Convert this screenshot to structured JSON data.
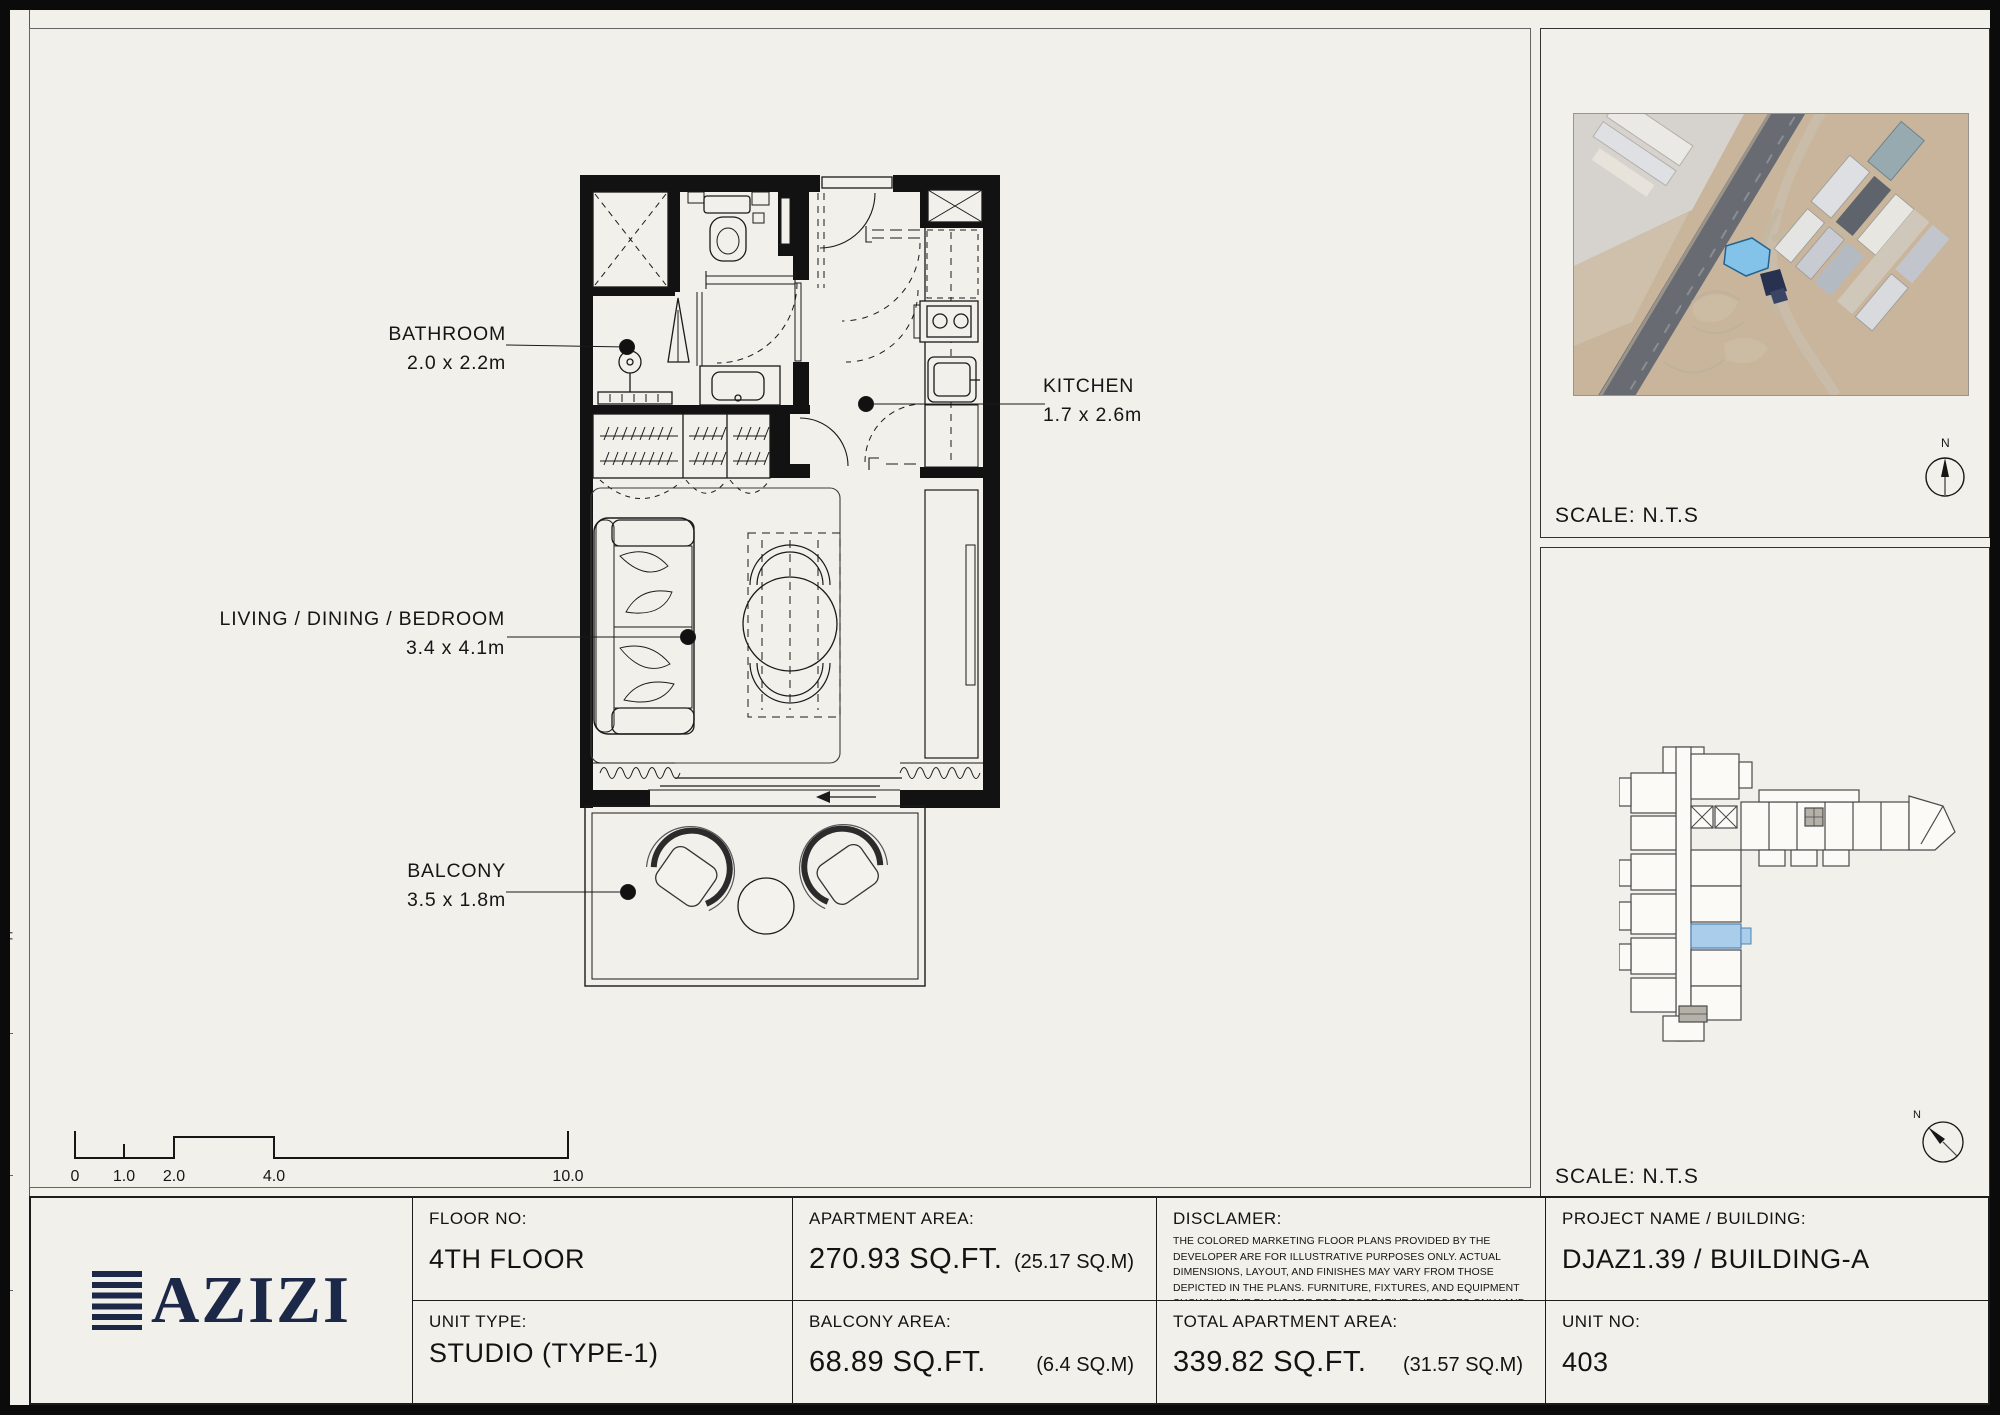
{
  "side_strip": {
    "s0": "SHEET SIZE A3",
    "s1": "DRAWN :    Author",
    "s2": "REVIEWED :    Checker",
    "s3": "APPROVED :    Approver"
  },
  "plan": {
    "bathroom": {
      "name": "BATHROOM",
      "dims": "2.0 x 2.2m"
    },
    "kitchen": {
      "name": "KITCHEN",
      "dims": "1.7 x 2.6m"
    },
    "living": {
      "name": "LIVING / DINING / BEDROOM",
      "dims": "3.4 x 4.1m"
    },
    "balcony": {
      "name": "BALCONY",
      "dims": "3.5 x 1.8m"
    }
  },
  "scale_bar": {
    "ticks": [
      "0",
      "1.0",
      "2.0",
      "4.0",
      "10.0"
    ]
  },
  "map_panel": {
    "scale": "SCALE: N.T.S",
    "north": "N"
  },
  "keyplan_panel": {
    "scale": "SCALE: N.T.S",
    "north": "N"
  },
  "title_block": {
    "logo": "AZIZI",
    "floor_label": "FLOOR NO:",
    "floor_value": "4TH FLOOR",
    "unit_type_label": "UNIT TYPE:",
    "unit_type_value": "STUDIO (TYPE-1)",
    "apt_label": "APARTMENT AREA:",
    "apt_value": "270.93 SQ.FT.",
    "apt_metric": "(25.17 SQ.M)",
    "balc_label": "BALCONY AREA:",
    "balc_value": "68.89 SQ.FT.",
    "balc_metric": "(6.4 SQ.M)",
    "disc_label": "DISCLAMER:",
    "disc_text": "THE COLORED MARKETING FLOOR PLANS PROVIDED BY THE DEVELOPER ARE FOR ILLUSTRATIVE PURPOSES ONLY. ACTUAL DIMENSIONS, LAYOUT, AND FINISHES MAY VARY FROM THOSE DEPICTED IN THE PLANS. FURNITURE, FIXTURES, AND EQUIPMENT SHOWN IN THE PLANS ARE FOR DECORATIVE PURPOSES ONLY AND ARE NOT INCLUDED IN THE PURCHASE OR LEASE OF THE PROPERTY. THE DEVELOPER RESERVES THE RIGHT TO MAKE MODIFICATIONS, REVISIONS, AND CHANGES TO THE FLOOR PLANS, SPECIFICATIONS, AND FEATURES WITHOUT PRIOR NOTICE.",
    "total_label": "TOTAL APARTMENT AREA:",
    "total_value": "339.82 SQ.FT.",
    "total_metric": "(31.57 SQ.M)",
    "project_label": "PROJECT NAME / BUILDING:",
    "project_value": "DJAZ1.39 / BUILDING-A",
    "unit_no_label": "UNIT NO:",
    "unit_no_value": "403"
  },
  "colors": {
    "paper": "#f2f0ea",
    "ink": "#161616",
    "logo_navy": "#1b2847",
    "plot_blue": "#83c3e9",
    "unit_blue": "#a9cdea"
  }
}
